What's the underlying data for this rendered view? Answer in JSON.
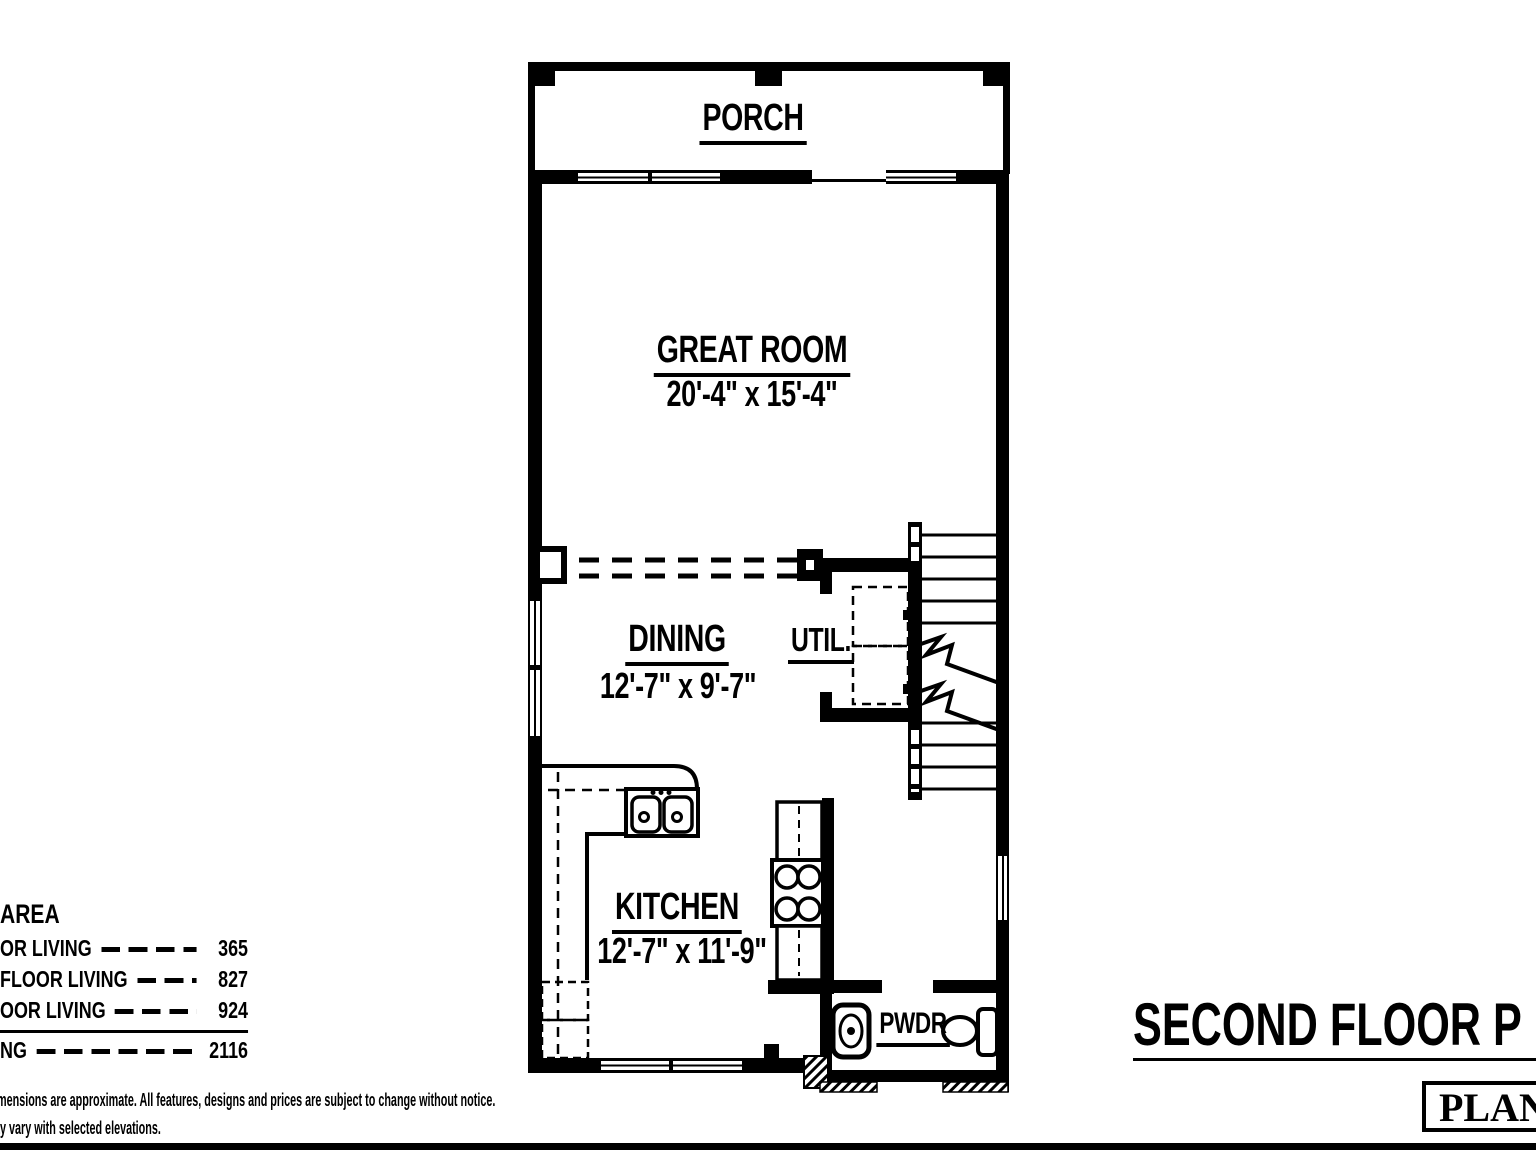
{
  "colors": {
    "ink": "#000000",
    "paper": "#ffffff"
  },
  "rooms": {
    "porch": {
      "label": "PORCH"
    },
    "great_room": {
      "label": "GREAT ROOM",
      "dims": "20'-4\" x 15'-4\""
    },
    "dining": {
      "label": "DINING",
      "dims": "12'-7\" x 9'-7\""
    },
    "util": {
      "label": "UTIL."
    },
    "kitchen": {
      "label": "KITCHEN",
      "dims": "12'-7\" x 11'-9\""
    },
    "powder": {
      "label": "PWDR"
    }
  },
  "area_table": {
    "title": "AREA",
    "rows": [
      {
        "label": "OR LIVING",
        "value": "365"
      },
      {
        "label": "FLOOR LIVING",
        "value": "827"
      },
      {
        "label": "OOR LIVING",
        "value": "924"
      }
    ],
    "total": {
      "label": "NG",
      "value": "2116"
    }
  },
  "sheet": {
    "title": "SECOND FLOOR P",
    "plan_box_label": "PLAN"
  },
  "disclaimer": {
    "line1": "imensions are approximate. All features, designs and prices are subject to change without notice.",
    "line2": "ay vary with selected elevations."
  }
}
